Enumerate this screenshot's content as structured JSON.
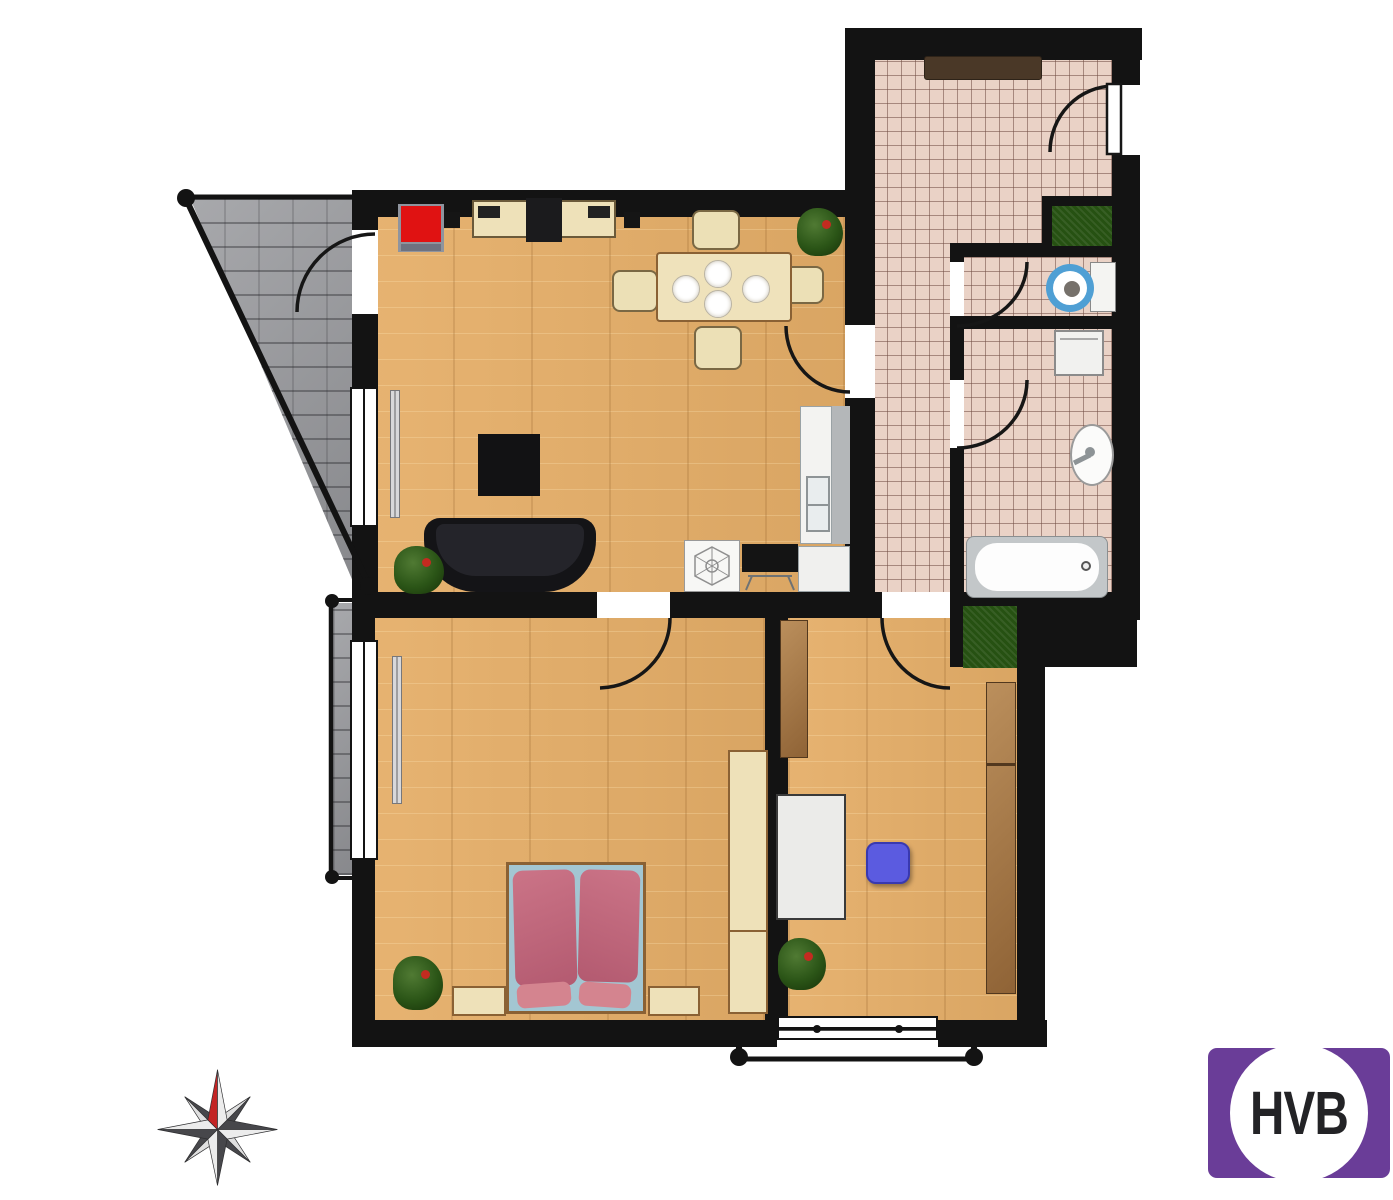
{
  "logo": {
    "text": "HVB",
    "background": "#6a3d98",
    "circle": "#ffffff",
    "text_color": "#232326"
  },
  "palette": {
    "wall": "#131313",
    "wood_floor": "#e5ae68",
    "tile_floor": "#ead2c6",
    "stone": "#97989c",
    "plant_green": "#2b5517",
    "bed_pink": "#c06a80",
    "sofa_black": "#141417",
    "desk_chair_blue": "#5b5be0",
    "toilet_blue": "#4f9fd4",
    "armchair_red": "#e01212",
    "cream_furniture": "#eee1b9",
    "cabinet_wood": "#a87a4e",
    "compass_north_red": "#c32424"
  },
  "compass": {
    "points": 8,
    "north_marker": "red"
  },
  "rooms": {
    "living_room": {
      "floor": "wood",
      "items": [
        "red-armchair",
        "sideboard",
        "tv",
        "speakers",
        "dining-table",
        "four-plates",
        "four-chairs",
        "plant",
        "coffee-table",
        "sofa",
        "plant",
        "radiator",
        "kitchen-counter",
        "kitchen-sink",
        "cooktop",
        "lamp-symbol-cabinet"
      ]
    },
    "bedroom": {
      "floor": "wood",
      "items": [
        "double-bed",
        "two-duvets",
        "two-pillows",
        "nightstand-left",
        "nightstand-right",
        "wardrobe",
        "plant",
        "radiator",
        "window"
      ]
    },
    "office": {
      "floor": "wood",
      "items": [
        "shelf",
        "desk",
        "blue-desk-chair",
        "plant",
        "wardrobe",
        "niche-plant",
        "window"
      ]
    },
    "hallway": {
      "floor": "tile",
      "items": [
        "doormat",
        "entrance-door",
        "wall-plant"
      ]
    },
    "wc": {
      "floor": "tile",
      "items": [
        "toilet",
        "cistern"
      ]
    },
    "bathroom": {
      "floor": "tile",
      "items": [
        "washing-machine",
        "sink",
        "bathtub"
      ]
    },
    "outdoor": {
      "items": [
        "triangular-terrace",
        "side-balcony",
        "french-balcony",
        "railings"
      ]
    }
  }
}
